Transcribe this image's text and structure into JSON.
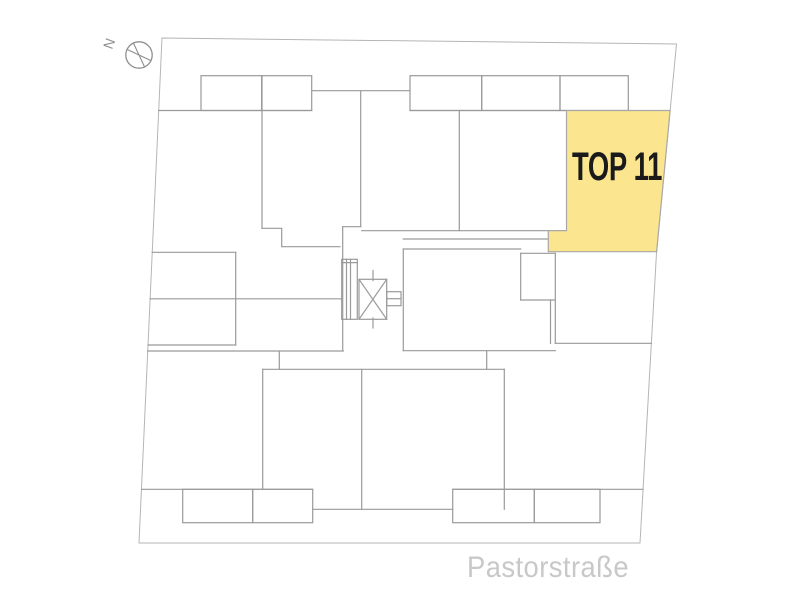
{
  "plan": {
    "highlighted_unit": {
      "label": "TOP 11"
    },
    "street": {
      "label": "Pastorstraße"
    },
    "compass": {
      "north_label": "N"
    }
  },
  "colors": {
    "background": "#ffffff",
    "unit_fill": "#fbe58f",
    "unit_outline": "#a8a8a8",
    "unit_text": "#1a1a1a",
    "street_text": "#c8c8c8",
    "wall": "#9a9a9a",
    "boundary": "#b5b5b5",
    "compass": "#8f8f8f"
  }
}
